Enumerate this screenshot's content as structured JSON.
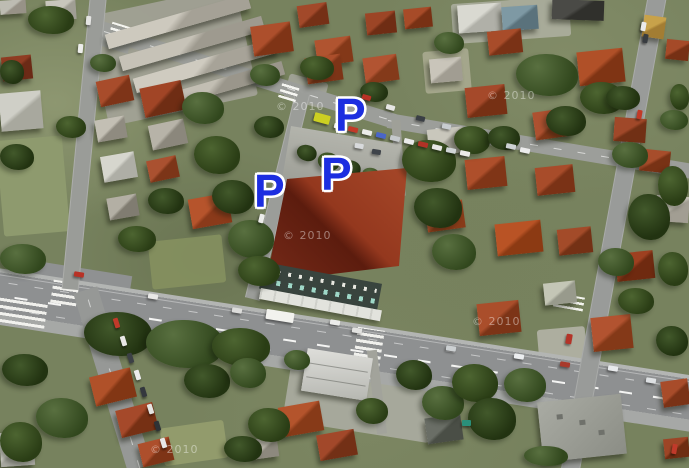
{
  "map": {
    "type": "satellite-aerial",
    "description": "Aerial satellite view of a city block with three parking locations marked",
    "markers": {
      "glyph": "P",
      "meaning": "parking",
      "fill_color": "#1c2ee0",
      "outline_color": "#ffffff",
      "items": [
        {
          "id": "parking-marker-north",
          "label": "P"
        },
        {
          "id": "parking-marker-center",
          "label": "P"
        },
        {
          "id": "parking-marker-west",
          "label": "P"
        }
      ]
    },
    "watermark": {
      "text": "© 2010",
      "color": "#ffffff",
      "opacity": 0.42
    }
  },
  "palette": {
    "marker_blue": "#1c2ee0",
    "road_gray": "#8f9192",
    "roof_red": "#a84c2a",
    "roof_dark_red": "#7a3216",
    "big_building_maroon": "#94381e",
    "tree_green": "#2c4016",
    "grass_green": "#77825e"
  }
}
